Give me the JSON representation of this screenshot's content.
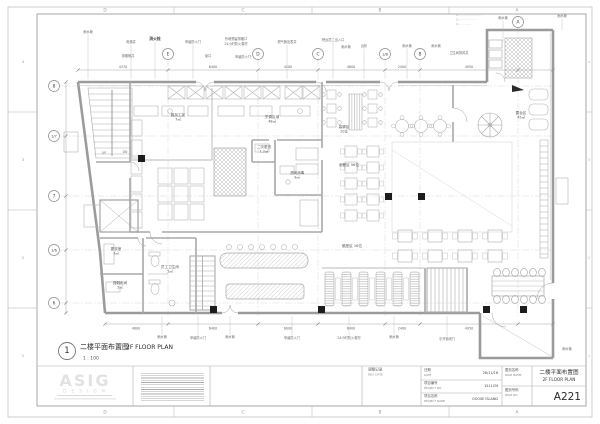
{
  "sheet": {
    "zone_letters": [
      "D",
      "C",
      "B",
      "A"
    ],
    "zone_numbers": [
      "4",
      "3",
      "2",
      "1"
    ]
  },
  "grid": {
    "top": [
      {
        "l": "E",
        "x": 168
      },
      {
        "l": "D",
        "x": 258
      },
      {
        "l": "C",
        "x": 318
      },
      {
        "l": "1/B",
        "x": 385
      },
      {
        "l": "B",
        "x": 420
      },
      {
        "l": "A",
        "x": 518,
        "y": 22
      }
    ],
    "left": [
      {
        "l": "8",
        "y": 86
      },
      {
        "l": "1/7",
        "y": 136
      },
      {
        "l": "7",
        "y": 196
      },
      {
        "l": "1/6",
        "y": 250
      },
      {
        "l": "6",
        "y": 303
      }
    ]
  },
  "dims_top": [
    {
      "v": "4370",
      "x": 123
    },
    {
      "v": "6400",
      "x": 213
    },
    {
      "v": "4200",
      "x": 288
    },
    {
      "v": "4800",
      "x": 351
    },
    {
      "v": "2400",
      "x": 402
    },
    {
      "v": "4950",
      "x": 469
    }
  ],
  "dims_bottom": [
    {
      "v": "4600",
      "x": 136
    },
    {
      "v": "6400",
      "x": 213
    },
    {
      "v": "6000",
      "x": 288
    },
    {
      "v": "6400",
      "x": 351
    },
    {
      "v": "2400",
      "x": 402
    },
    {
      "v": "4950",
      "x": 469
    }
  ],
  "callouts_top": [
    {
      "t": "雨水管",
      "x": 88,
      "y": 33
    },
    {
      "t": "电梯井",
      "x": 131,
      "y": 43
    },
    {
      "t": "消火栓",
      "x": 155,
      "y": 40,
      "b": 1
    },
    {
      "t": "排烟管井",
      "x": 128,
      "y": 57,
      "nl": 1
    },
    {
      "t": "甲级防火门",
      "x": 193,
      "y": 43
    },
    {
      "t": "窗口",
      "x": 208,
      "y": 57,
      "nl": 1
    },
    {
      "t": "外墙预留排烟口",
      "x": 236,
      "y": 40,
      "nl": 1
    },
    {
      "t": "24小时防火卷帘",
      "x": 236,
      "y": 45,
      "nl": 1
    },
    {
      "t": "甲级防火门",
      "x": 243,
      "y": 58,
      "nl": 1
    },
    {
      "t": "燃气管及表井",
      "x": 287,
      "y": 43
    },
    {
      "t": "吧台员工出入口",
      "x": 333,
      "y": 41
    },
    {
      "t": "雨水管",
      "x": 346,
      "y": 48,
      "nl": 1
    },
    {
      "t": "台阶",
      "x": 364,
      "y": 47
    },
    {
      "t": "雨水管",
      "x": 407,
      "y": 47
    },
    {
      "t": "雨水管",
      "x": 436,
      "y": 47,
      "nl": 1
    },
    {
      "t": "卫生间排风井",
      "x": 459,
      "y": 54,
      "nl": 1
    },
    {
      "t": "雨水管",
      "x": 503,
      "y": 19,
      "ly": 42
    },
    {
      "t": "雨水管",
      "x": 562,
      "y": 17,
      "ly": 30
    }
  ],
  "callouts_bottom": [
    {
      "t": "雨水管",
      "x": 162,
      "y": 338
    },
    {
      "t": "甲级防火门",
      "x": 198,
      "y": 339
    },
    {
      "t": "雨水管",
      "x": 230,
      "y": 338
    },
    {
      "t": "甲级防火门",
      "x": 292,
      "y": 339
    },
    {
      "t": "24小时防火卷帘",
      "x": 349,
      "y": 339
    },
    {
      "t": "雨水管",
      "x": 394,
      "y": 338
    },
    {
      "t": "平开锁闭门",
      "x": 447,
      "y": 340
    },
    {
      "t": "雨水管",
      "x": 567,
      "y": 350,
      "side": "r"
    }
  ],
  "rooms": [
    {
      "t": "粗加工区",
      "t2": "7㎡",
      "x": 178,
      "y": 116
    },
    {
      "t": "烹调区域",
      "t2": "48㎡",
      "x": 272,
      "y": 118
    },
    {
      "t": "二次更衣",
      "t2": "1.2㎡",
      "x": 264,
      "y": 148
    },
    {
      "t": "洗碗消毒",
      "t2": "9㎡",
      "x": 297,
      "y": 174
    },
    {
      "t": "高脚区",
      "t2": "20位",
      "x": 344,
      "y": 128
    },
    {
      "t": "用餐区 56位",
      "x": 349,
      "y": 166
    },
    {
      "t": "散座区 16位",
      "x": 352,
      "y": 247
    },
    {
      "t": "露台区",
      "t2": "45㎡",
      "x": 521,
      "y": 114
    },
    {
      "t": "更衣室",
      "t2": "3㎡",
      "x": 116,
      "y": 250
    },
    {
      "t": "强弱电间",
      "t2": "5㎡",
      "x": 120,
      "y": 284
    },
    {
      "t": "员工卫生间",
      "t2": "5㎡",
      "x": 170,
      "y": 268
    }
  ],
  "stair_labels": [
    {
      "t": "UP",
      "x": 104,
      "y": 154
    },
    {
      "t": "DN",
      "x": 125,
      "y": 153
    }
  ],
  "terrace_notes": [
    "2.··························",
    "3.····················",
    "4.··············"
  ],
  "drawing_title": {
    "number": "1",
    "title_cn": "二楼平面布置图",
    "title_en": "2F FLOOR PLAN",
    "scale": "1 : 100"
  },
  "logo": {
    "name": "ASIG",
    "sub": "D E S I G N"
  },
  "title_block": {
    "rev_cn": "调整记录",
    "rev_en": "REV. DATE",
    "date_cn": "日期",
    "date_en": "DATE",
    "date_value": "26/11/16",
    "project_no_cn": "项目编号",
    "project_no_en": "PROJECT NO.",
    "project_no_value": "1511CM",
    "project_name_cn": "项目名称",
    "project_name_en": "PROJECT NAME",
    "project_name_value": "GOOSE ISLAND",
    "page_name_cn": "图页名称",
    "page_name_en": "PAGE NAME",
    "page_no_cn": "图页号码",
    "page_no_en": "PAGE NO.",
    "page_title_cn": "二楼平面布置图",
    "page_title_en": "2F FLOOR PLAN",
    "page_no_value": "A221"
  }
}
